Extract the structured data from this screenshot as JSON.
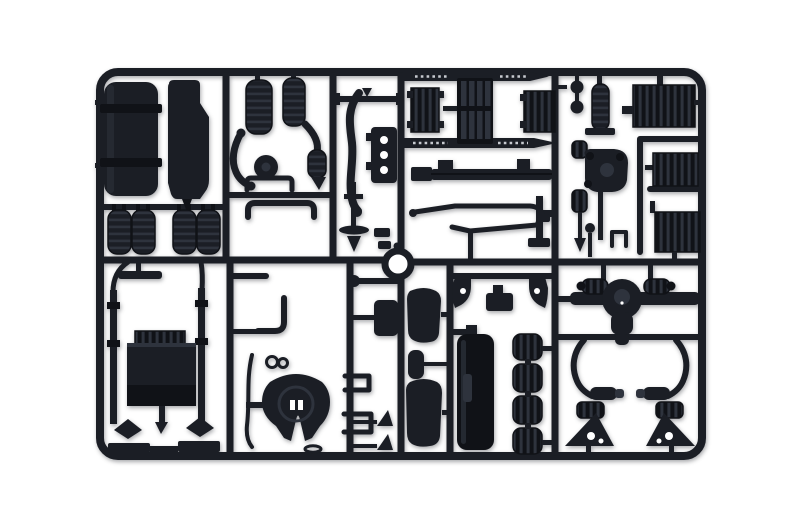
{
  "scene": {
    "description": "Photograph of a dark charcoal-grey injection-moulded plastic sprue (parts tree) from a truck model kit, laid on a plain white background. The rectangular runner frame holds chassis parts: fuel tank, exhaust stack, air tanks, radiator cores and grille, ribbed equipment boxes, engine block, fifth-wheel coupling plate, mirror arms, rear axle with differential and paired suspension units.",
    "alt": "Model kit sprue with dark grey truck chassis parts on white background"
  },
  "colors": {
    "bg": "#ffffff",
    "plastic": "#1b1e25",
    "plastic-deep": "#101217",
    "plastic-lite": "#2e333d",
    "plastic-hi": "#3b414d",
    "perforation": "#c7cad0"
  },
  "parts": [
    {
      "label": "Fuel tank with straps"
    },
    {
      "label": "Exhaust stack"
    },
    {
      "label": "Air reservoir cylinder"
    },
    {
      "label": "Air reservoir cylinder"
    },
    {
      "label": "Curved intake hose"
    },
    {
      "label": "Intake hose with bellows"
    },
    {
      "label": "Flywheel disc"
    },
    {
      "label": "Mounting bracket"
    },
    {
      "label": "Bumper guard"
    },
    {
      "label": "Long exhaust pipe"
    },
    {
      "label": "Wing bracket"
    },
    {
      "label": "Backing plate with three holes"
    },
    {
      "label": "Chassis side guard, perforated, top"
    },
    {
      "label": "Chassis side guard, perforated, bottom"
    },
    {
      "label": "Radiator core, left"
    },
    {
      "label": "Radiator grille with slats"
    },
    {
      "label": "Radiator core, right"
    },
    {
      "label": "Front bumper bar"
    },
    {
      "label": "Knob pair"
    },
    {
      "label": "Air filter canister"
    },
    {
      "label": "Front hub and differential assembly"
    },
    {
      "label": "Ribbed battery box"
    },
    {
      "label": "Ribbed equipment box, middle"
    },
    {
      "label": "Ribbed equipment box, lower"
    },
    {
      "label": "L-bracket with foot"
    },
    {
      "label": "C-bracket"
    },
    {
      "label": "Steering linkage rod"
    },
    {
      "label": "Small fittings"
    },
    {
      "label": "Drive shaft with joint and cone"
    },
    {
      "label": "Row of four ribbed air tanks"
    },
    {
      "label": "Wiper blade"
    },
    {
      "label": "Mirror arm with diamond head, left"
    },
    {
      "label": "Mirror arm with diamond head, right"
    },
    {
      "label": "Engine block with ribbed valve cover"
    },
    {
      "label": "Fifth-wheel coupling plate"
    },
    {
      "label": "Elbow pipe"
    },
    {
      "label": "Knob"
    },
    {
      "label": "Mud flap"
    },
    {
      "label": "Step brackets"
    },
    {
      "label": "Wheel chocks"
    },
    {
      "label": "Mirror housing, upper"
    },
    {
      "label": "Small mirror"
    },
    {
      "label": "Mirror housing, lower"
    },
    {
      "label": "Spring hangers with centre bracket"
    },
    {
      "label": "Side panel"
    },
    {
      "label": "Stack of ribbed canisters"
    },
    {
      "label": "Rear axle with differential"
    },
    {
      "label": "Suspension unit, left"
    },
    {
      "label": "Suspension unit, right"
    },
    {
      "label": "Ball fitting"
    },
    {
      "label": "Sprue runner frame"
    },
    {
      "label": "Locating ring"
    },
    {
      "label": "Gear lever rod"
    }
  ]
}
